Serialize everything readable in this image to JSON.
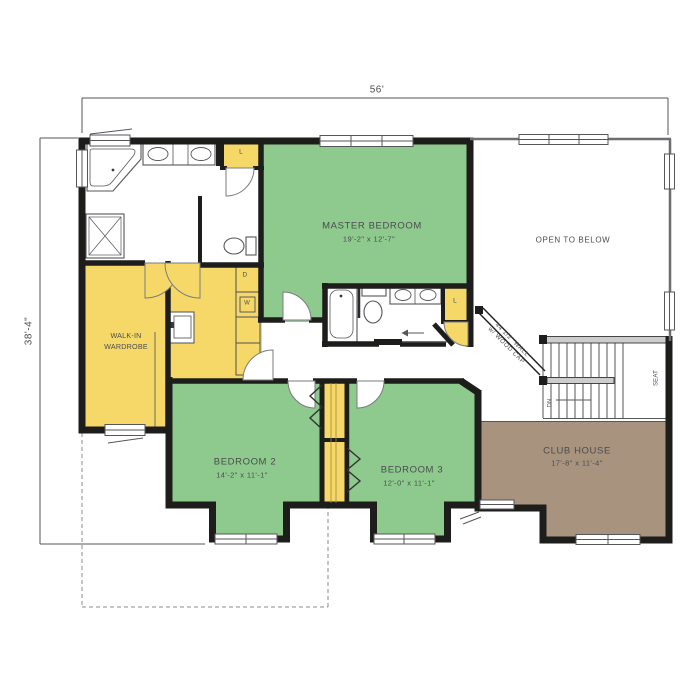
{
  "plan": {
    "dimension_top": "56'",
    "dimension_left": "38'-4\"",
    "rooms": {
      "master_bedroom": {
        "name": "MASTER BEDROOM",
        "dims": "19'-2\" x 12'-7\""
      },
      "bedroom_2": {
        "name": "BEDROOM 2",
        "dims": "14'-2\" x 11'-1\""
      },
      "bedroom_3": {
        "name": "BEDROOM 3",
        "dims": "12'-0\" x 11'-1\""
      },
      "club_house": {
        "name": "CLUB HOUSE",
        "dims": "17'-8\" x 11'-4\""
      },
      "walk_in_wardrobe": {
        "name_line1": "WALK-IN",
        "name_line2": "WARDROBE"
      },
      "open_to_below": {
        "name": "OPEN TO BELOW"
      }
    },
    "annotations": {
      "stair_wall_line1": "44 1/2\" WALL",
      "stair_wall_line2": "w/ WOOD CAP",
      "down": "DN",
      "seat": "SEAT",
      "linen_top": "L",
      "linen_hall": "L",
      "dryer": "D",
      "washer": "W"
    },
    "colors": {
      "bedroom_green": "#8ec98e",
      "closet_yellow": "#f6d869",
      "club_brown": "#a8937f",
      "wall_black": "#1d1d1b",
      "line_gray": "#55565a"
    }
  }
}
